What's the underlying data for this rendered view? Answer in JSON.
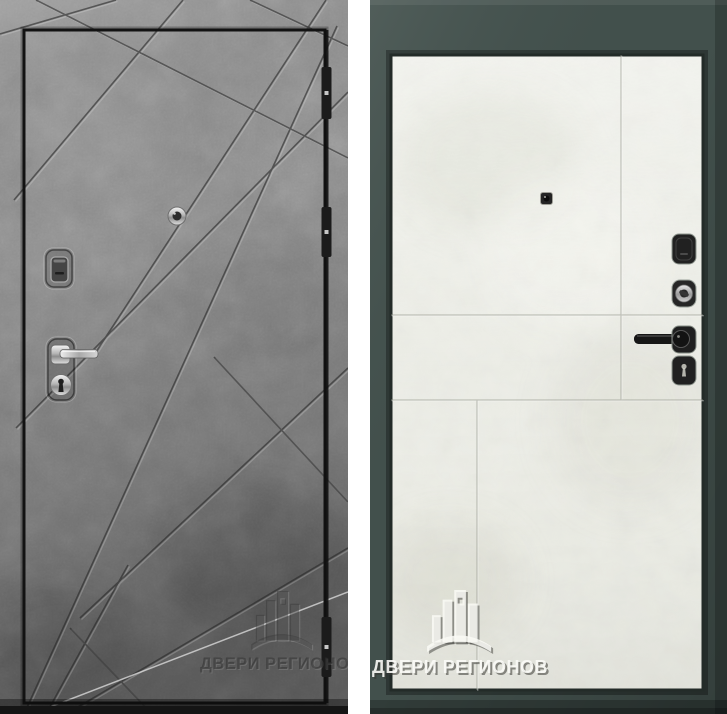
{
  "image": {
    "description": "Product photo of a steel entry door: exterior side (left) and interior side (right)",
    "views": 2
  },
  "watermark": {
    "brand": "ДВЕРИ РЕГИОНОВ",
    "logo": "buildings-logo"
  },
  "left_view": {
    "side": "exterior",
    "finish": "gray-concrete-loft-with-diagonal-grooves",
    "hardware": [
      "keyhole-cover",
      "peephole",
      "chrome-lever-handle",
      "cylinder-lock"
    ],
    "hinge_count": 3
  },
  "right_view": {
    "side": "interior",
    "finish": "ivory-white-panel",
    "frame": "dark-graphite-green",
    "hardware": [
      "peephole",
      "lock-cover",
      "night-latch-knob",
      "black-lever-handle",
      "keyhole-cover"
    ]
  },
  "colors": {
    "concrete_base": "#8d8d8d",
    "concrete_dark": "#5f5f5f",
    "leaf_outline": "#121212",
    "frame_slate": "#42504c",
    "panel_ivory": "#edeee7",
    "divider_white": "#ffffff",
    "chrome": "#d9d9d9",
    "hardware_black": "#222222"
  }
}
